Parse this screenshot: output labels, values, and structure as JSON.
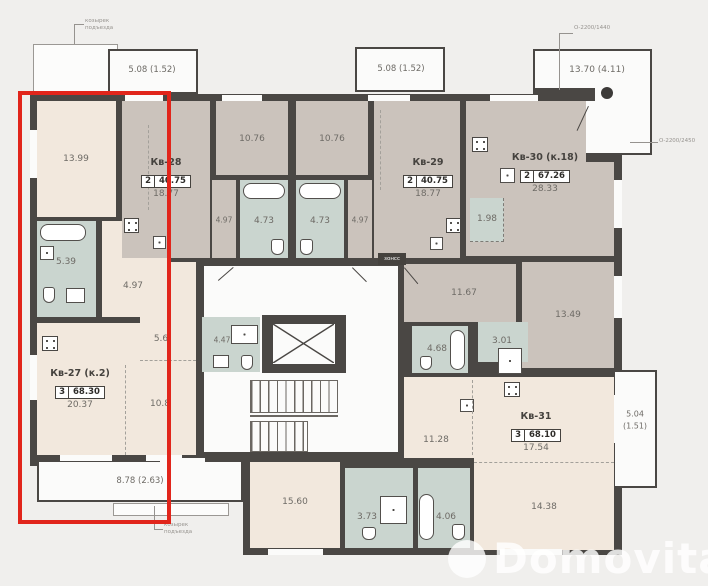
{
  "plan_title": "Floor plan with apartment Кв-27 highlighted",
  "colors": {
    "wall": "#4a4744",
    "room_beige": "#f2e8dd",
    "room_gray": "#cbc3bc",
    "room_wet": "#cad5cf",
    "highlight_red": "#e1251b",
    "background": "#f0efed"
  },
  "apartments": [
    {
      "name": "Кв-27 (к.2)",
      "rooms": "3",
      "total_area": "68.30",
      "living_area": "20.37",
      "highlighted": true
    },
    {
      "name": "Кв-28",
      "rooms": "2",
      "total_area": "40.75",
      "living_area": "18.77",
      "highlighted": false
    },
    {
      "name": "Кв-29",
      "rooms": "2",
      "total_area": "40.75",
      "living_area": "18.77",
      "highlighted": false
    },
    {
      "name": "Кв-30 (к.18)",
      "rooms": "2",
      "total_area": "67.26",
      "living_area": "28.33",
      "highlighted": false
    },
    {
      "name": "Кв-31",
      "rooms": "3",
      "total_area": "68.10",
      "living_area": "17.54",
      "highlighted": false
    }
  ],
  "areas": {
    "kv27_room1": "13.99",
    "kv27_bath": "5.39",
    "kv27_hall": "4.97",
    "kv27_corridor": "5.6",
    "kv27_room2": "10.8",
    "kv28_kitchen": "10.76",
    "kv28_bath": "4.73",
    "kv28_hall": "4.97",
    "kv29_kitchen": "10.76",
    "kv29_bath": "4.73",
    "kv29_hall": "4.97",
    "kv30_storage": "1.98",
    "kv30_room2": "11.67",
    "kv30_room3": "13.49",
    "kv30_bath": "4.68",
    "kv30_bath2": "3.01",
    "stair_bath": "4.47",
    "kv31_room2": "11.28",
    "kv31_room3": "14.38",
    "kv31_room4": "15.60",
    "kv31_bath": "3.73",
    "kv31_bath2": "4.06"
  },
  "balconies": {
    "top_left": "5.08 (1.52)",
    "top_middle": "5.08 (1.52)",
    "terrace": "13.70 (4.11)",
    "bottom_left": "8.78 (2.63)",
    "right_line1": "5.04",
    "right_line2": "(1.51)"
  },
  "callouts": {
    "canopy_line1": "козырек",
    "canopy_line2": "подъезда",
    "window_top": "О-2200/1440",
    "window_right": "О-2200/2450",
    "utility": "зонсс"
  },
  "watermark": {
    "text": "Domovita"
  }
}
